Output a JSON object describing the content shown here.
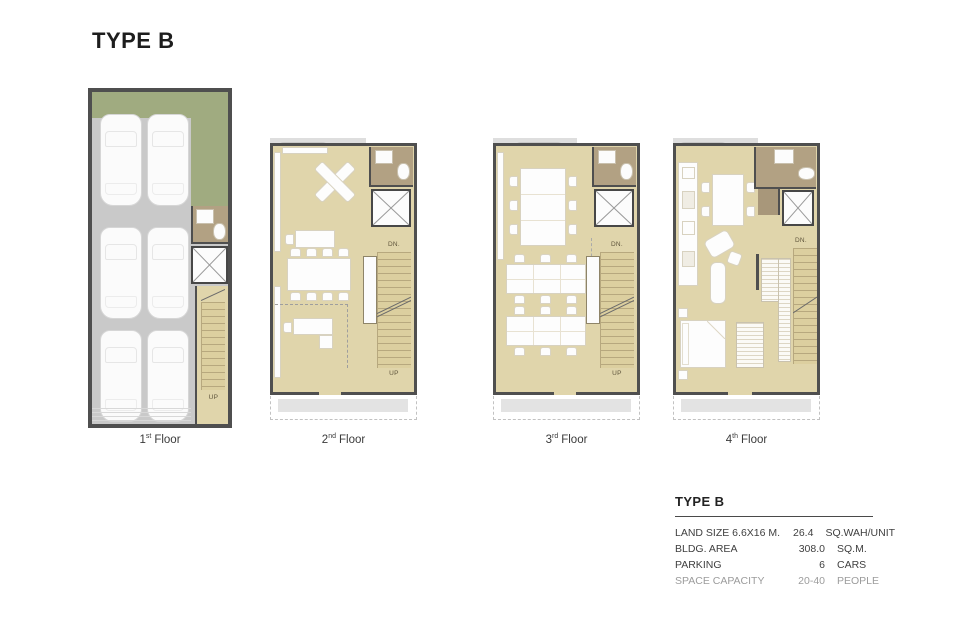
{
  "title": "TYPE B",
  "floors": [
    {
      "num": "1",
      "ord": "st",
      "word": "Floor",
      "stairs": {
        "up": "UP"
      }
    },
    {
      "num": "2",
      "ord": "nd",
      "word": "Floor",
      "stairs": {
        "down": "DN.",
        "up": "UP"
      }
    },
    {
      "num": "3",
      "ord": "rd",
      "word": "Floor",
      "stairs": {
        "down": "DN.",
        "up": "UP"
      }
    },
    {
      "num": "4",
      "ord": "th",
      "word": "Floor",
      "stairs": {
        "down": "DN."
      }
    }
  ],
  "spec": {
    "title": "TYPE B",
    "rows": [
      {
        "label": "LAND SIZE 6.6X16 M.",
        "value": "26.4",
        "unit": "SQ.WAH/UNIT"
      },
      {
        "label": "BLDG. AREA",
        "value": "308.0",
        "unit": "SQ.M."
      },
      {
        "label": "PARKING",
        "value": "6",
        "unit": "CARS"
      },
      {
        "label": "SPACE CAPACITY",
        "value": "20-40",
        "unit": "PEOPLE"
      }
    ]
  },
  "colors": {
    "wall": "#4f4f4f",
    "floor_beige": "#e0d5ab",
    "stair_beige": "#dccf9f",
    "bathroom_tan": "#b2a183",
    "landscape_green": "#a0ab80",
    "parking_gray": "#c9c9c9",
    "canopy_gray": "#dedede",
    "furniture_white": "#fdfdfd"
  }
}
